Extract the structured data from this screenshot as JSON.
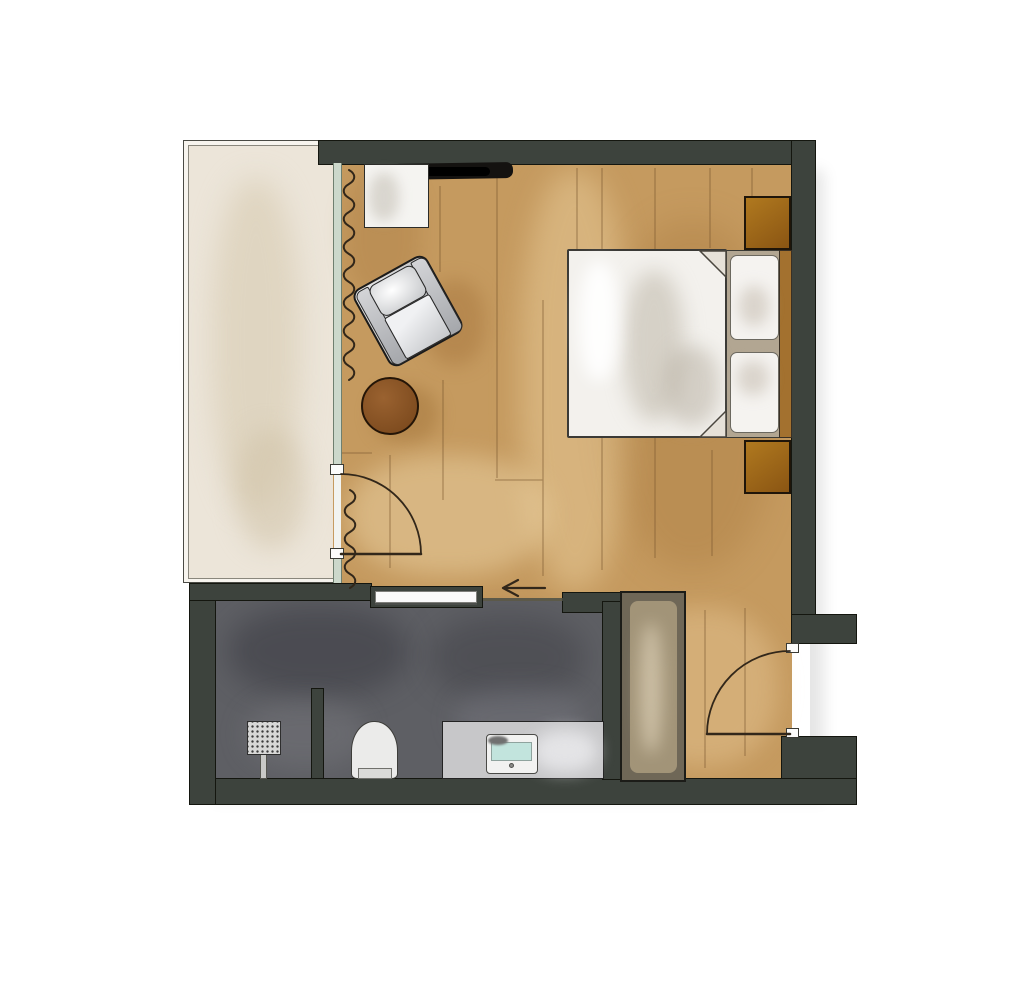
{
  "plan": {
    "type": "floor-plan",
    "style": "hand-rendered-watercolor",
    "rooms": [
      "balcony",
      "bedroom-living-room",
      "bathroom",
      "entry-hall"
    ],
    "furniture": [
      "armchair",
      "round-ottoman",
      "side-table",
      "wall-mounted-tv",
      "double-bed",
      "pillow",
      "pillow",
      "headboard",
      "nightstand-upper",
      "nightstand-lower",
      "wardrobe"
    ],
    "fixtures": [
      "rain-shower-head",
      "shower-partition",
      "wall-hung-toilet",
      "vanity-counter",
      "sink-basin",
      "sliding-bathroom-door",
      "balcony-hinged-door",
      "entry-hinged-door",
      "curtain",
      "window-wall-glazing",
      "entry-direction-arrow"
    ]
  },
  "colors": {
    "wall-color": "#3d433d",
    "wood-color": "#c59a5f",
    "wood-line-color": "#7b5830",
    "balcony-floor-color": "#ece5d9",
    "bath-floor-color": "#5e5f64",
    "glass-color": "#ccd8cb",
    "bedding-color": "#f3f1ed",
    "headboard-color": "#b2a692",
    "nightstand-color": "#a26a24",
    "pouf-color": "#8a5527",
    "wardrobe-color": "#6f6757",
    "wardrobe-inner-color": "#a29478",
    "counter-color": "#c7c7c9",
    "basin-color": "#c2e4dd",
    "toilet-color": "#ebebea",
    "shower-color": "#d8d8d7",
    "chair-color": "#c9cbce",
    "tv-color": "#141210",
    "line-color": "#32271a"
  }
}
